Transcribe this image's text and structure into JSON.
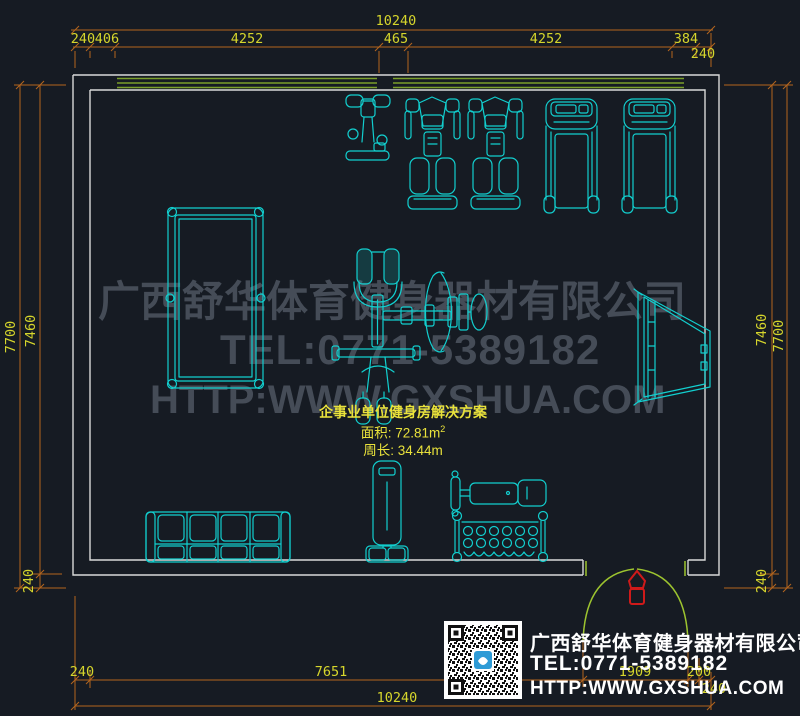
{
  "colors": {
    "background": "#161b23",
    "equipment_cyan": "#12cfcf",
    "wall_white": "#d9d9d9",
    "wall_hatch_green": "#7ba02b",
    "door_green": "#9dc42f",
    "dim_line_orange": "#b4651e",
    "dim_text_yellow": "#d6d62c",
    "plan_text_yellow": "#e9e23b",
    "watermark_gray": "#454c57",
    "door_marker_red": "#cf1a1a",
    "qr_logo_blue": "#2e9bd6"
  },
  "dims": {
    "top": {
      "total": "10240",
      "segments": [
        "240",
        "406",
        "4252",
        "465",
        "4252",
        "384"
      ],
      "right_offset": "240"
    },
    "left": {
      "outer": "7700",
      "inner": "7460",
      "bottom": "240"
    },
    "right": {
      "inner": "7460",
      "outer": "7700",
      "bottom": "240"
    },
    "bottom": {
      "segments": [
        "240",
        "7651",
        "1909",
        "200"
      ],
      "right_offset": "240",
      "total": "10240"
    }
  },
  "plan_info": {
    "title": "企事业单位健身房解决方案",
    "area": "面积: 72.81m",
    "area_sup": "2",
    "perimeter": "周长: 34.44m"
  },
  "watermark": {
    "line1": "广西舒华体育健身器材有限公司",
    "line2": "TEL:0771-5389182",
    "line3": "HTTP:WWW.GXSHUA.COM"
  },
  "footer": {
    "company": "广西舒华体育健身器材有限公司",
    "tel": "TEL:0771-5389182",
    "url": "HTTP:WWW.GXSHUA.COM"
  },
  "equipment": [
    "upright-exercise-bike",
    "strength-machine",
    "strength-machine",
    "treadmill",
    "treadmill",
    "billiard-table",
    "multi-station-gym",
    "wall-mounted-trainer",
    "four-seat-sofa",
    "boxing-bag-stand",
    "flat-bench",
    "dumbbell-rack",
    "double-swing-entry-door"
  ]
}
